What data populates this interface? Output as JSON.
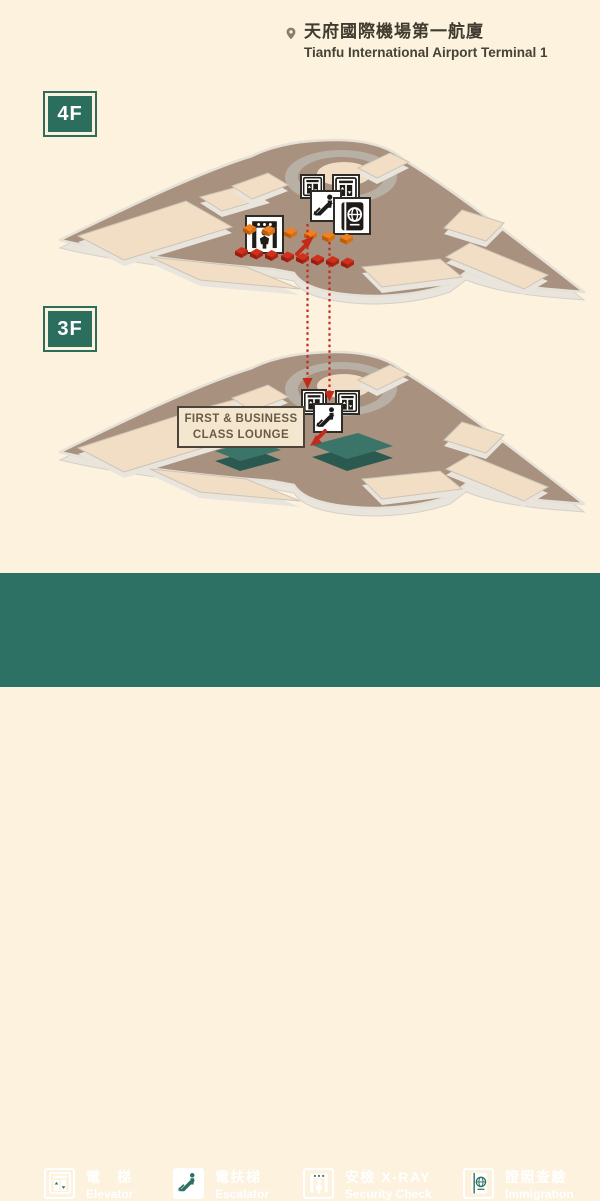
{
  "header": {
    "title_zh": "天府國際機場第一航廈",
    "title_en": "Tianfu International Airport Terminal 1"
  },
  "floor_4f": {
    "badge": "4F",
    "icons": [
      "elevator-icon",
      "elevator-icon",
      "escalator-icon",
      "immigration-icon",
      "security-check-icon"
    ],
    "route": "security queue (red and orange markers) leading to escalator down to 3F"
  },
  "floor_3f": {
    "badge": "3F",
    "icons": [
      "elevator-icon",
      "elevator-icon",
      "escalator-icon"
    ],
    "lounge_label_line1": "FIRST & BUSINESS",
    "lounge_label_line2": "CLASS LOUNGE"
  },
  "legend": {
    "items": [
      {
        "icon": "elevator-icon",
        "zh": "電　梯",
        "en": "Elevator"
      },
      {
        "icon": "escalator-icon",
        "zh": "電扶梯",
        "en": "Escalator"
      },
      {
        "icon": "security-check-icon",
        "zh": "安檢 X-RAY",
        "en": "Security Check"
      },
      {
        "icon": "immigration-icon",
        "zh": "證照查驗",
        "en": "Immigration"
      }
    ]
  },
  "colors": {
    "background": "#fcf2de",
    "legend_bar": "#2d7164",
    "badge_green": "#2c6e5e",
    "floor_brown": "#a8917e",
    "platform_peach": "#f2dec4",
    "lounge_teal": "#3b7569",
    "route_red": "#c4291c",
    "route_orange": "#ef8120",
    "label_bg": "#f3e8cf",
    "label_text": "#6d5848"
  }
}
